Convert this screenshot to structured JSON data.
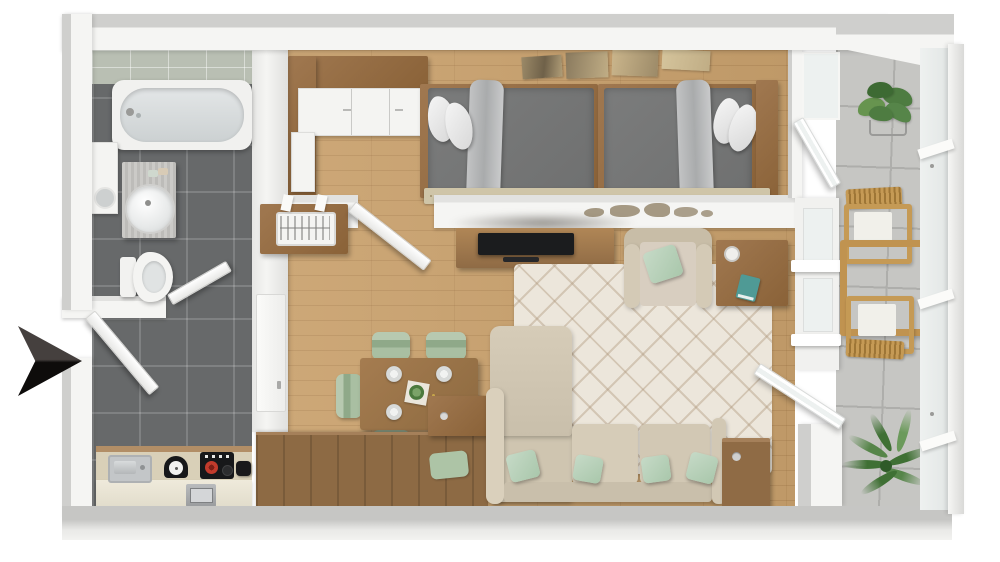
{
  "image": {
    "kind": "3d-floor-plan-render",
    "view": "top-down"
  },
  "colors": {
    "background": "#ffffff",
    "wall_face": "#f5f5f3",
    "wall_top": "#cfcfcd",
    "wall_shadow": "#e2e2e0",
    "tile_floor": "#67696a",
    "bath_wall_tile": "#b9bfb3",
    "wood_floor": "#c9a16d",
    "furniture_wood": "#a07850",
    "furniture_wood_dark": "#8a6238",
    "sideboard_wood": "#8d6a44",
    "counter_cream": "#efeadb",
    "counter_top": "#d9d0b8",
    "backsplash_wood": "#b28e66",
    "steel": "#c3c6c8",
    "appliance_black": "#17181a",
    "burner_red": "#c23b2c",
    "marble": "#c6c5c2",
    "bed_gray": "#6f7070",
    "blanket_gray": "#b5b6b7",
    "pillow_white": "#ececec",
    "runner_beige": "#cfc5a8",
    "art_tan": "#c0ad85",
    "map_brown": "#8a7a5e",
    "sofa_beige": "#cfc5b0",
    "cushion_beige": "#d6ccb8",
    "mint": "#a9c7ab",
    "sage": "#a9bfa2",
    "sage_dark": "#8fa989",
    "rug_base": "#ece6db",
    "rug_line": "#b0997e",
    "tv_black": "#1b1c1e",
    "teal": "#4f9a95",
    "metal_gray": "#9a9c9e",
    "balcony_floor": "#c6c6c3",
    "balcony_grout": "#aeaeab",
    "plant_green": "#4e7c41",
    "palm_green": "#3f7034",
    "chair_wood": "#c59a55",
    "glass": "#edf1f0",
    "arrow_dark": "#45403e",
    "arrow_black": "#0e0c0b"
  },
  "floorplan": {
    "entrance": {
      "marker": "black-direction-arrow",
      "points": "right",
      "location": "left-wall"
    },
    "rooms": [
      {
        "name": "bathroom",
        "floor": "dark-gray-tile",
        "items": [
          "bathtub",
          "washing-machine",
          "vanity-with-round-sink",
          "toilet",
          "open-door"
        ]
      },
      {
        "name": "hallway",
        "floor": "dark-gray-tile",
        "items": [
          "entrance-open-door",
          "closed-door-to-living-room"
        ]
      },
      {
        "name": "kitchen",
        "floor": "dark-gray-tile",
        "items": [
          "kitchen-counter",
          "stainless-sink",
          "kitchen-scale",
          "cooktop-with-red-burner",
          "pot",
          "oven"
        ]
      },
      {
        "name": "bedroom",
        "floor": "light-oak-wood",
        "items": [
          "l-shaped-wardrobe",
          "single-bed-left",
          "single-bed-right",
          "white-pillows",
          "gray-duvets",
          "draped-throws",
          "wood-headboard",
          "patterned-runner-rug",
          "four-panel-wall-art",
          "open-glass-door-to-balcony",
          "open-door-to-living-room"
        ]
      },
      {
        "name": "living-dining-room",
        "floor": "light-oak-wood",
        "items": [
          "radiator-cabinet",
          "tv-console",
          "flat-tv",
          "soundbar",
          "world-map-wall-art",
          "dining-table",
          "dining-chairs-x5",
          "dinner-plates-x4",
          "centerpiece",
          "armchair",
          "side-table-with-mug-and-notebook",
          "l-shaped-sofa",
          "mint-throw-pillows",
          "diamond-pattern-rug",
          "wooden-sideboard",
          "storage-cabinets",
          "open-glass-door-to-balcony"
        ]
      },
      {
        "name": "balcony",
        "floor": "concrete-tile",
        "items": [
          "potted-plant-on-stand",
          "wooden-armchair-x2",
          "wooden-coffee-table",
          "palm-plant",
          "floor-to-ceiling-glazing"
        ]
      }
    ]
  }
}
